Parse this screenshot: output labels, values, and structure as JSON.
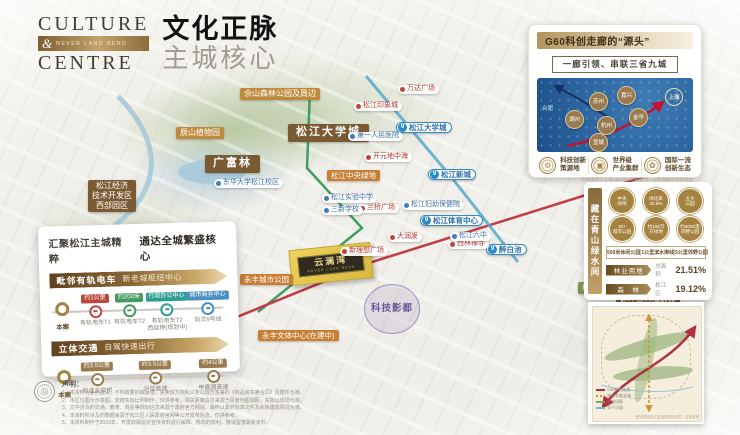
{
  "logo": {
    "line1": "CULTURE",
    "amp": "&",
    "band_text": "NEVER LAND BEND",
    "line2": "CENTRE",
    "title_cn": "文化正脉",
    "subtitle_cn": "主城核心"
  },
  "g60_card": {
    "title": "G60科创走廊的“源头”",
    "subtitle": "一廊引领、串联三省九城",
    "hefei": "合肥",
    "shanghai": "上海",
    "nodes": [
      {
        "label": "苏州",
        "x": 52,
        "y": 14
      },
      {
        "label": "嘉兴",
        "x": 80,
        "y": 8
      },
      {
        "label": "湖州",
        "x": 28,
        "y": 32
      },
      {
        "label": "杭州",
        "x": 60,
        "y": 38
      },
      {
        "label": "金华",
        "x": 92,
        "y": 30
      },
      {
        "label": "宣城",
        "x": 52,
        "y": 55
      }
    ],
    "features": [
      {
        "icon": "tech-innovation-icon",
        "glyph": "⚙",
        "label": "科技创新\n策源地"
      },
      {
        "icon": "industry-cluster-icon",
        "glyph": "▣",
        "label": "世界级\n产业集群"
      },
      {
        "icon": "innovation-eco-icon",
        "glyph": "✿",
        "label": "国际一流\n创新生态"
      }
    ],
    "caption": "*数据来源于上海G60科创走廊官网，以政府最终规划为准"
  },
  "left_card": {
    "title_left": "汇聚松江主城精粹",
    "title_right": "通达全城繁盛核心",
    "origin_label": "本案",
    "sections": [
      {
        "bar_bold": "毗邻有轨电车",
        "bar_light": "新老城枢纽中心",
        "stops": [
          {
            "tag": "约1公里",
            "color": "#b9473f",
            "label": "有轨电车T1"
          },
          {
            "tag": "约200米",
            "color": "#44995f",
            "label": "有轨电车T2"
          },
          {
            "tag": "行政办公中心",
            "color": "#2f9e92",
            "label": "有轨电车T2\n西延伸(规划中)"
          },
          {
            "tag": "城市商务中心",
            "color": "#4a8ec2",
            "label": "轨交9号线"
          }
        ]
      },
      {
        "bar_bold": "立体交通",
        "bar_light": "自驾快速出行",
        "stops": [
          {
            "tag": "约3.5公里",
            "color": "#9a7b4f",
            "label": "松江立交桥"
          },
          {
            "tag": "约3.5公里",
            "color": "#9a7b4f",
            "label": "沪昆高速"
          },
          {
            "tag": "约4公里",
            "color": "#9a7b4f",
            "label": "申嘉湖高速"
          }
        ]
      }
    ]
  },
  "green_card": {
    "vertical_title": "藏在青山绿水间",
    "badges": [
      "中央\n绿地",
      "绿化率\n25.8%",
      "五大\n公园",
      "30+\n城市公园",
      "约168万\n方绿地",
      "约5000亩\n郊野公园"
    ],
    "metrics": [
      "500米休闲公园",
      "1公里滨水岸线",
      "5公里郊野公园"
    ],
    "stats": [
      {
        "bar": "林业用地",
        "mid": "总面积",
        "value": "21.51%"
      },
      {
        "bar": "森　林",
        "mid": "松江区",
        "value": "19.12%"
      }
    ]
  },
  "project": {
    "name": "云澜湾",
    "en": "NEVER LAND BEND"
  },
  "map": {
    "metro_line": "9",
    "labels": [
      {
        "text": "佘山森林公园及周边",
        "type": "park",
        "x": 240,
        "y": 88
      },
      {
        "text": "辰山植物园",
        "type": "park",
        "x": 176,
        "y": 127
      },
      {
        "text": "广富林",
        "type": "brownlg",
        "x": 205,
        "y": 155
      },
      {
        "text": "松江大学城",
        "type": "brownlg",
        "x": 288,
        "y": 124
      },
      {
        "text": "松江中央绿地",
        "type": "orange",
        "x": 327,
        "y": 170
      },
      {
        "text": "松江经济\n技术开发区\n西部园区",
        "type": "brown",
        "x": 88,
        "y": 180
      },
      {
        "text": "松南郊野公园",
        "type": "parkgreen",
        "x": 578,
        "y": 282
      },
      {
        "text": "松江南交通枢纽",
        "type": "brown",
        "x": 616,
        "y": 296
      },
      {
        "text": "科技影都",
        "type": "purple",
        "x": 364,
        "y": 284
      },
      {
        "text": "松江大学城",
        "type": "metro",
        "x": 396,
        "y": 122
      },
      {
        "text": "松江新城",
        "type": "metro",
        "x": 428,
        "y": 169
      },
      {
        "text": "松江体育中心",
        "type": "metro",
        "x": 420,
        "y": 215
      },
      {
        "text": "醉白池",
        "type": "metro",
        "x": 486,
        "y": 244
      },
      {
        "text": "松江印象城",
        "type": "red",
        "x": 354,
        "y": 102
      },
      {
        "text": "万达广场",
        "type": "red",
        "x": 398,
        "y": 85
      },
      {
        "text": "开元地中海",
        "type": "red",
        "x": 364,
        "y": 153
      },
      {
        "text": "大润发",
        "type": "red",
        "x": 388,
        "y": 233
      },
      {
        "text": "新理想广场",
        "type": "red",
        "x": 340,
        "y": 247
      },
      {
        "text": "西林禅寺",
        "type": "red",
        "x": 448,
        "y": 240
      },
      {
        "text": "兰桥广场",
        "type": "red",
        "x": 358,
        "y": 204
      },
      {
        "text": "第一人民医院",
        "type": "blue",
        "x": 348,
        "y": 132
      },
      {
        "text": "松江妇幼保健院",
        "type": "blue",
        "x": 402,
        "y": 201
      },
      {
        "text": "松江六中",
        "type": "blue",
        "x": 450,
        "y": 232
      },
      {
        "text": "三新学校",
        "type": "blue",
        "x": 322,
        "y": 206
      },
      {
        "text": "松江实验中学",
        "type": "blue",
        "x": 322,
        "y": 194
      },
      {
        "text": "东华大学松江校区",
        "type": "blue",
        "x": 214,
        "y": 179
      },
      {
        "text": "永丰城市公园",
        "type": "orange",
        "x": 240,
        "y": 274
      },
      {
        "text": "永丰文体中心(在建中)",
        "type": "orange",
        "x": 258,
        "y": 330
      }
    ]
  },
  "inset_map": {
    "legend": [
      {
        "swatch": "red",
        "label": "G60科创走廊"
      },
      {
        "swatch": "gold",
        "label": "城市发展主轴"
      },
      {
        "swatch": "green",
        "label": "生态绿廊"
      },
      {
        "swatch": "blue",
        "label": "骨干河道"
      }
    ],
    "caption": "*图示源自松江区相关规划示意，仅供参考"
  },
  "disclaimer": {
    "heading": "声明：",
    "lines": [
      "1、本资料为要约邀请，不构成要约或承诺，买卖双方权利义务以双方签署的《商品房买卖合同》及附件为准。",
      "2、本区位图为示意图，非按实际比例制作，仅供参考，相关距离信息来源于百度地图测距，实际以现场为准。",
      "3、文中涉及的交通、教育、商业等规划信息来源于政府官方网站，最终以政府批准文件及实际建成情况为准。",
      "4、本资料所涉及的数据来源于松江区人民政府官网等公开发布信息，仅供参考。",
      "5、本资料制作于2023年，开发商保留对宣传资料进行解释、修改的权利，敬请留意最新资料。"
    ]
  }
}
